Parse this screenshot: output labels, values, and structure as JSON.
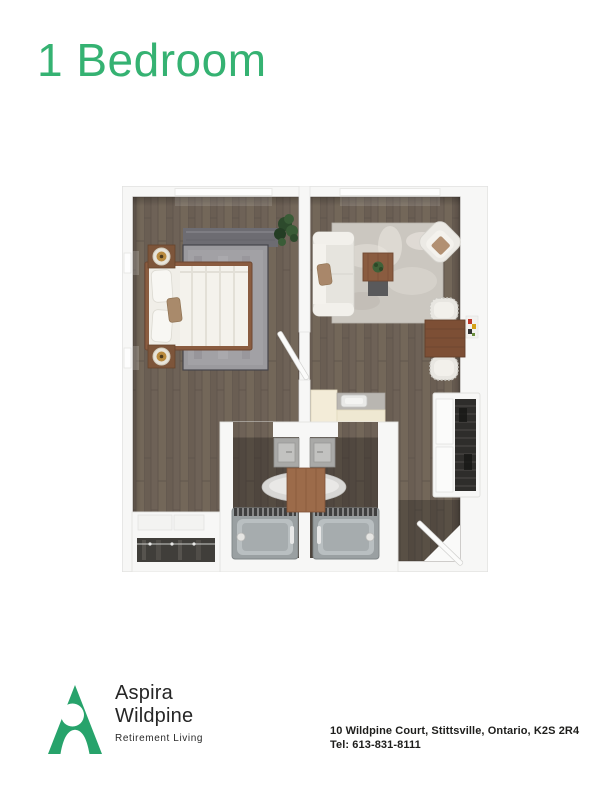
{
  "page": {
    "title": "1 Bedroom"
  },
  "brand": {
    "name_line1": "Aspira",
    "name_line2": "Wildpine",
    "tagline": "Retirement Living",
    "logo_color": "#27a36b",
    "title_color": "#35b272"
  },
  "contact": {
    "address": "10 Wildpine Court, Stittsville, Ontario, K2S 2R4",
    "phone": "Tel: 613-831-8111"
  },
  "floor_plan": {
    "alt": "Top-down 3D rendered floor plan of a one-bedroom suite with bedroom, living/dining area, kitchenette, two back-to-back bathrooms, closets and entry door",
    "colors": {
      "wood_floor": "#6e6257",
      "walls": "#f7f7f6",
      "bedroom_rug": "#9b9a9e",
      "living_rug": "#cbc7c0",
      "wood_furniture": "#8a5c40",
      "upholstery": "#eae8e3",
      "kitchen_counter": "#efe8d2",
      "fixtures": "#9aa0a2"
    }
  }
}
